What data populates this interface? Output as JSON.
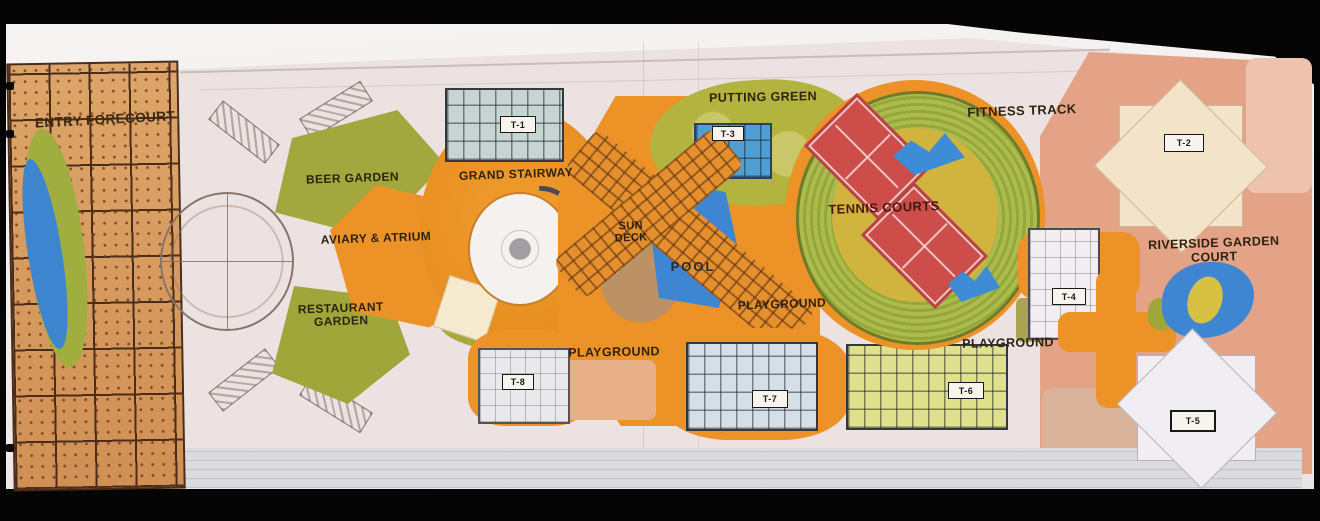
{
  "areas": {
    "entry_forecourt": {
      "label": "ENTRY FORECOURT"
    },
    "beer_garden": {
      "label": "BEER GARDEN"
    },
    "aviary_atrium": {
      "label": "AVIARY & ATRIUM"
    },
    "restaurant_garden": {
      "label": "RESTAURANT GARDEN"
    },
    "grand_stairway": {
      "label": "GRAND STAIRWAY"
    },
    "putting_green": {
      "label": "PUTTING GREEN"
    },
    "sun_deck": {
      "label": "SUN DECK"
    },
    "pool": {
      "label": "POOL"
    },
    "playground_center": {
      "label": "PLAYGROUND"
    },
    "playground_south": {
      "label": "PLAYGROUND"
    },
    "playground_east": {
      "label": "PLAYGROUND"
    },
    "tennis_courts": {
      "label": "TENNIS COURTS"
    },
    "fitness_track": {
      "label": "FITNESS TRACK"
    },
    "riverside_garden_court": {
      "label": "RIVERSIDE GARDEN COURT"
    }
  },
  "towers": {
    "t1": {
      "label": "T-1"
    },
    "t2": {
      "label": "T-2"
    },
    "t3": {
      "label": "T-3"
    },
    "t4": {
      "label": "T-4"
    },
    "t5": {
      "label": "T-5"
    },
    "t6": {
      "label": "T-6"
    },
    "t7": {
      "label": "T-7"
    },
    "t8": {
      "label": "T-8"
    }
  },
  "colors": {
    "frame_black": "#050505",
    "path_orange": "#ec9226",
    "lawn_green": "#a2a83d",
    "track_green": "#93a839",
    "water_blue": "#3f86d2",
    "court_red": "#cc4d4a",
    "court_center_yellow": "#d0b43e",
    "paving_tan": "#d9a162",
    "sun_deck_brown": "#bd9166",
    "salmon_pink": "#e4a386",
    "tower6_yellow": "#e0e18c",
    "tower7_blue": "#d4dfe8",
    "tower2_cream": "#f3e3c9"
  }
}
